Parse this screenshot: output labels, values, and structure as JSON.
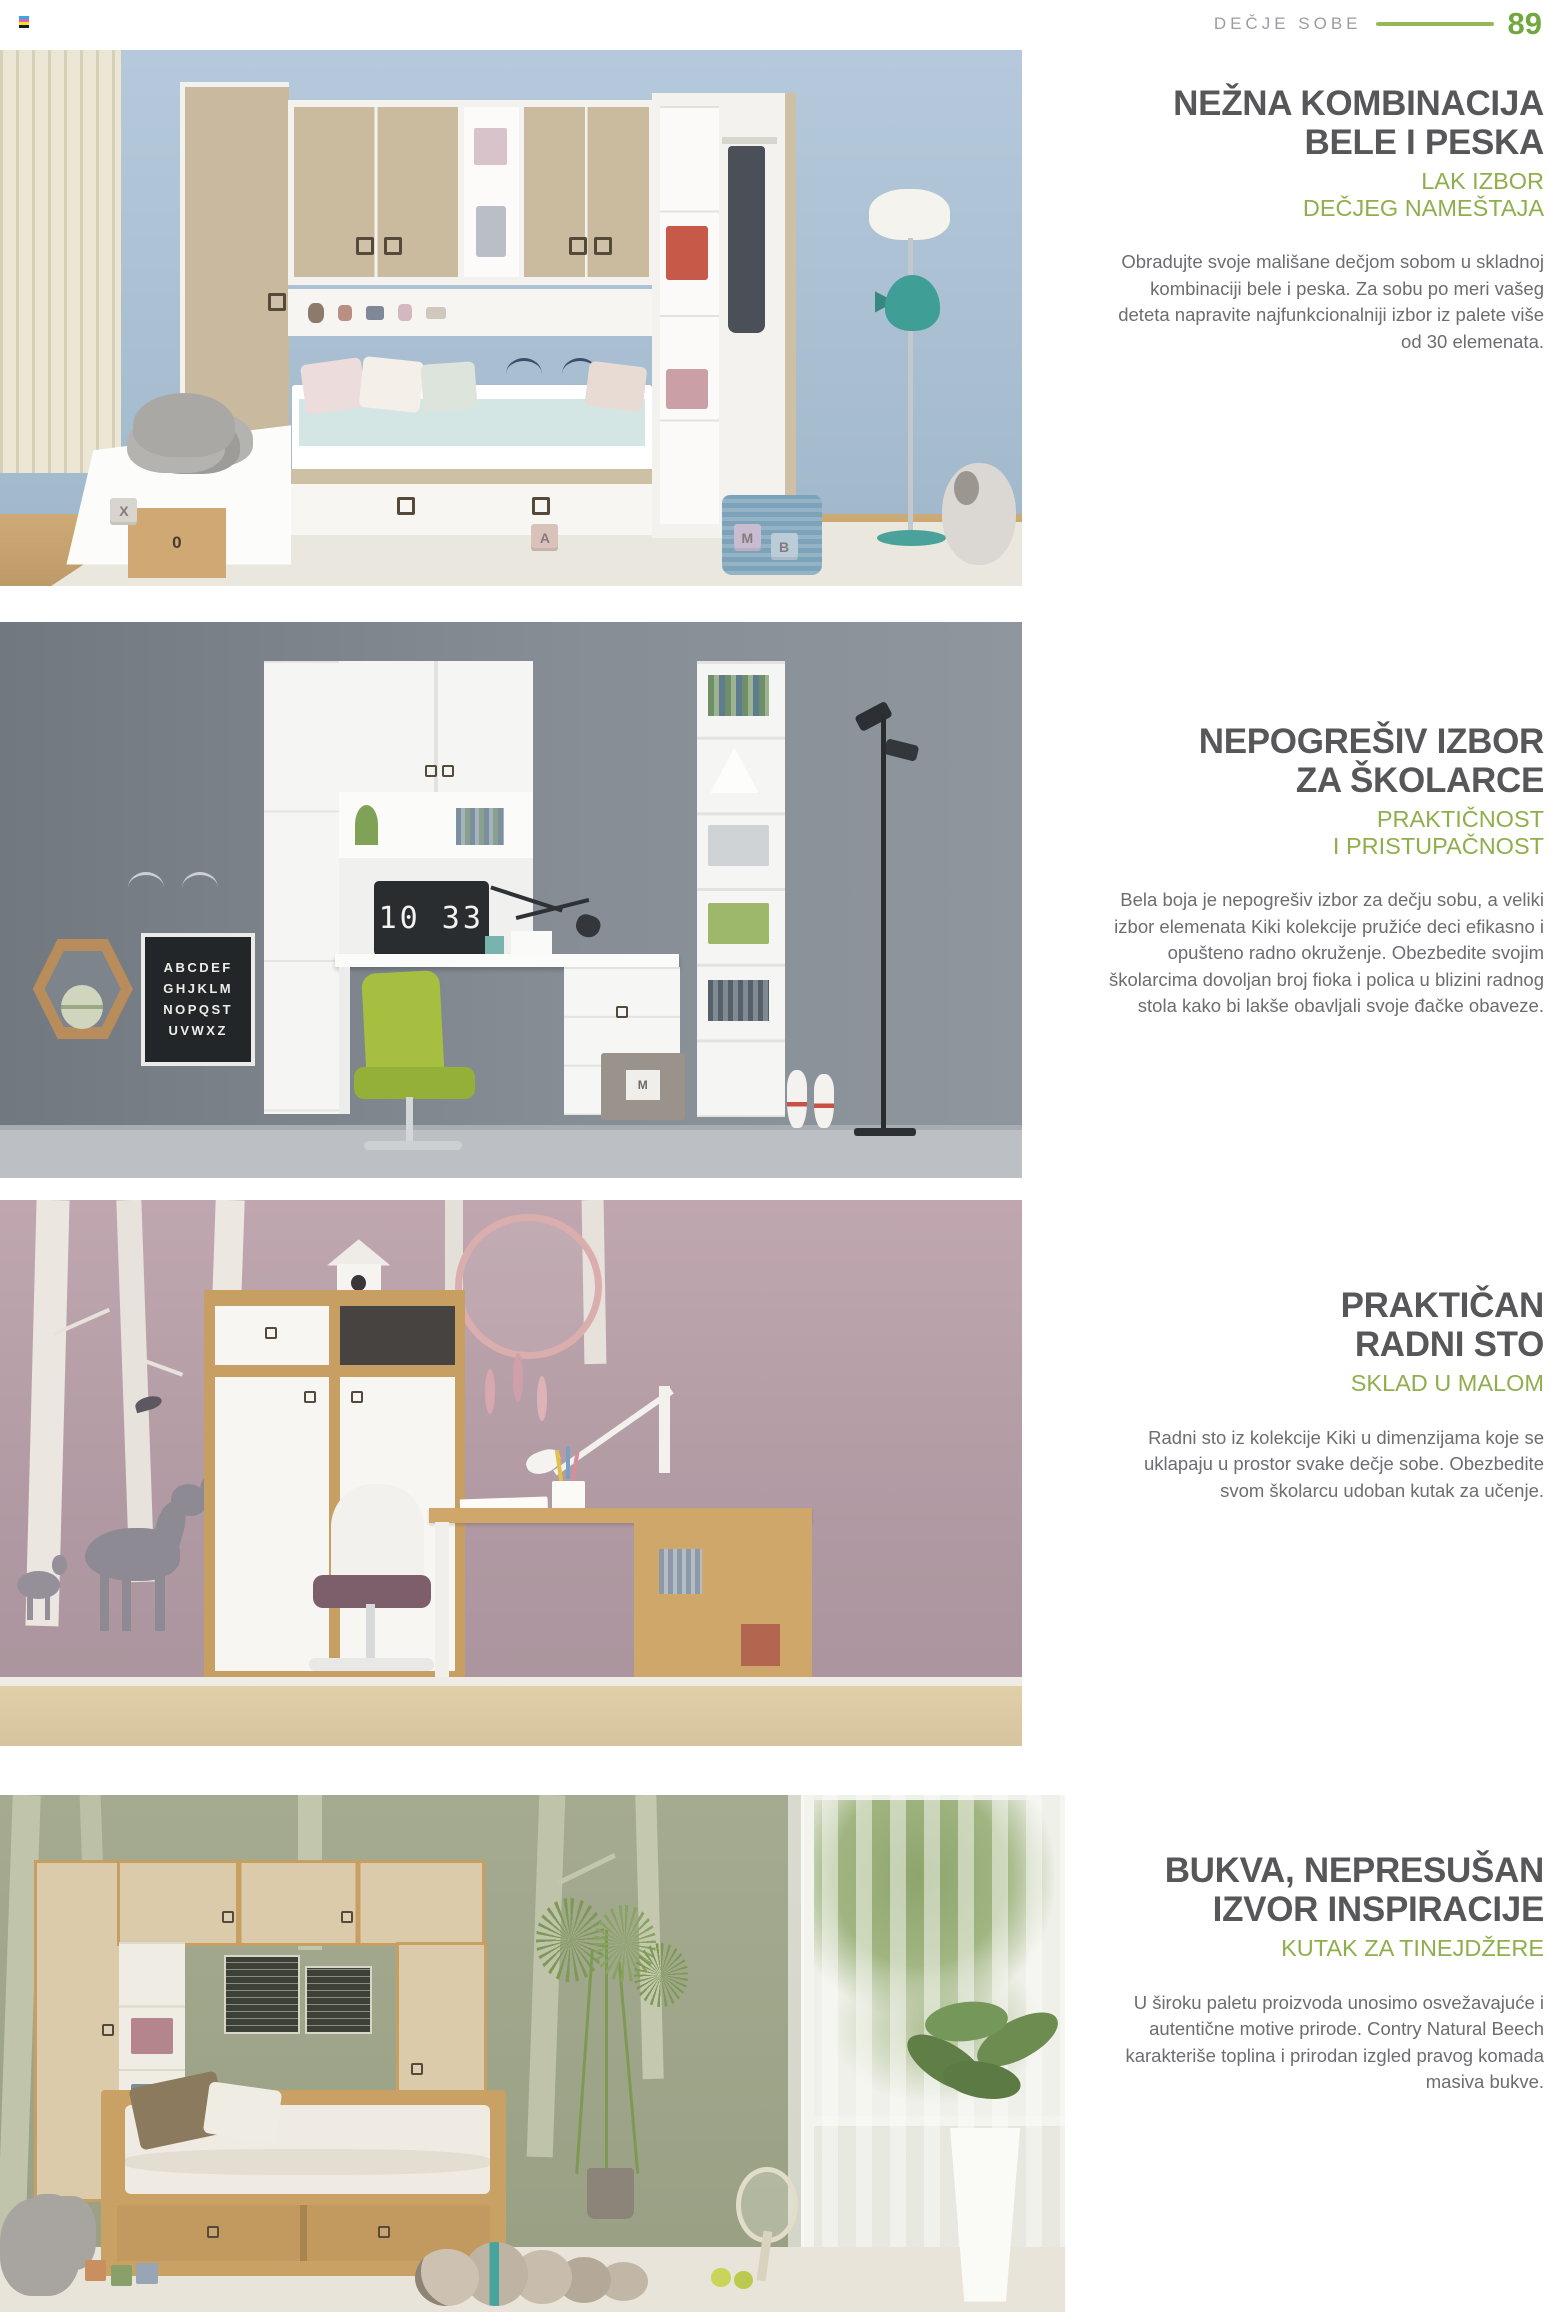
{
  "header": {
    "section_label": "DEČJE SOBE",
    "page_number": "89"
  },
  "accent": {
    "green": "#8fae4c",
    "title_gray": "#57575a",
    "body_gray": "#6c6d70"
  },
  "sections": [
    {
      "title_lines": [
        "NEŽNA KOMBINACIJA",
        "BELE I PESKA"
      ],
      "subtitle_lines": [
        "LAK IZBOR",
        "DEČJEG NAMEŠTAJA"
      ],
      "body": "Obradujte svoje mališane dečjom sobom u skladnoj kombinaciji bele i peska. Za sobu po meri vašeg deteta napravite najfunkcionalniji izbor iz palete više od 30 elemenata.",
      "photo": {
        "blocks": [
          "X",
          "A",
          "M",
          "B"
        ],
        "crate_digit": "0"
      }
    },
    {
      "title_lines": [
        "NEPOGREŠIV IZBOR",
        "ZA ŠKOLARCE"
      ],
      "subtitle_lines": [
        "PRAKTIČNOST",
        "I PRISTUPAČNOST"
      ],
      "body": "Bela boja je nepogrešiv izbor za dečju sobu, a veliki izbor elemenata Kiki kolekcije pružiće deci efikasno i opušteno radno okruženje. Obezbedite svojim školarcima dovoljan broj fioka i polica u blizini radnog stola kako bi lakše obavljali svoje đačke obaveze.",
      "photo": {
        "clock_time": "10 33",
        "poster_lines": [
          "ABCDEF",
          "GHJKLM",
          "NOPQST",
          "UVWXZ"
        ],
        "box_letter": "M"
      }
    },
    {
      "title_lines": [
        "PRAKTIČAN",
        "RADNI STO"
      ],
      "subtitle_lines": [
        "SKLAD U MALOM"
      ],
      "body": "Radni sto iz kolekcije Kiki u dimenzijama koje se uklapaju u prostor svake dečje sobe. Obezbedite svom školarcu udoban kutak za učenje."
    },
    {
      "title_lines": [
        "BUKVA, NEPRESUŠAN",
        "IZVOR INSPIRACIJE"
      ],
      "subtitle_lines": [
        "KUTAK ZA TINEJDŽERE"
      ],
      "body": "U široku paletu proizvoda unosimo osvežavajuće i autentične motive prirode. Contry Natural Beech karakteriše toplina i prirodan izgled pravog komada masiva bukve."
    }
  ]
}
